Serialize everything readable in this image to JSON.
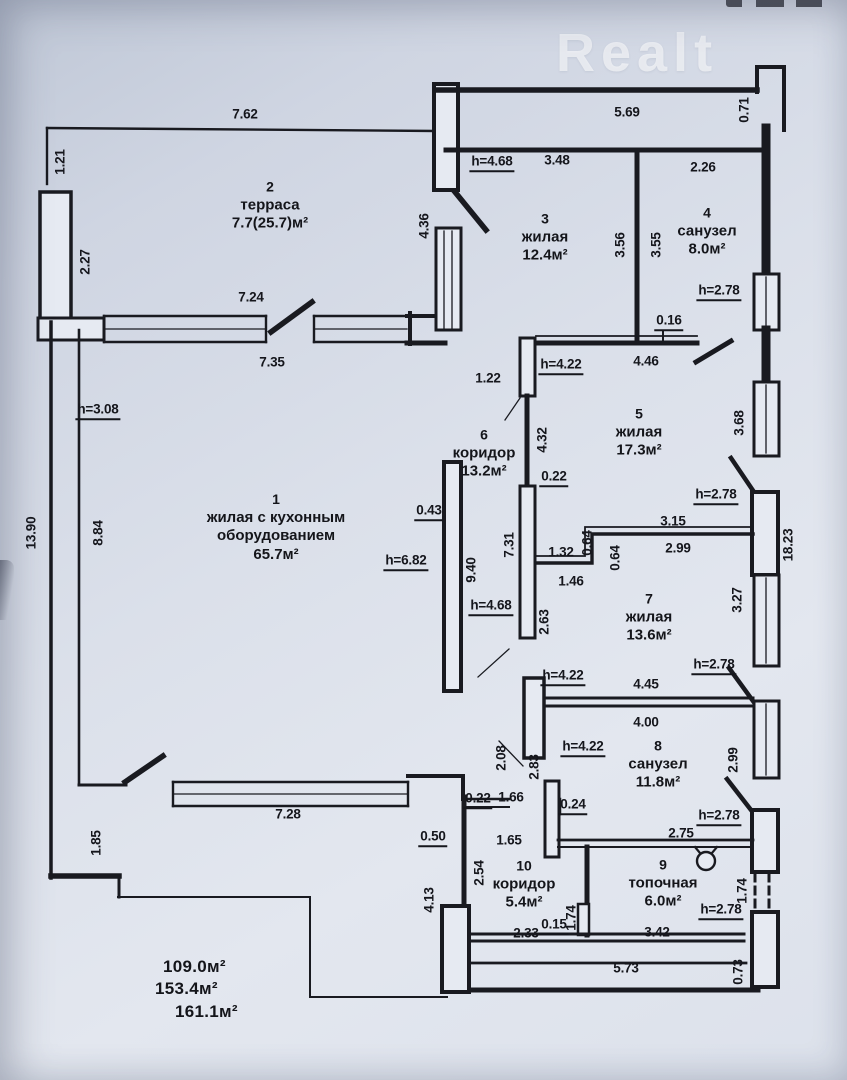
{
  "watermark": "Realt",
  "colors": {
    "paper_top": "#c3cad9",
    "paper_bottom": "#e2e6ee",
    "ink": "#191a20"
  },
  "totals": [
    "109.0м²",
    "153.4м²",
    "161.1м²"
  ],
  "rooms": [
    {
      "lines": [
        "2",
        "терраса",
        "7.7(25.7)м²"
      ],
      "x": 270,
      "y": 206
    },
    {
      "lines": [
        "3",
        "жилая",
        "12.4м²"
      ],
      "x": 545,
      "y": 238
    },
    {
      "lines": [
        "4",
        "санузел",
        "8.0м²"
      ],
      "x": 707,
      "y": 232
    },
    {
      "lines": [
        "5",
        "жилая",
        "17.3м²"
      ],
      "x": 639,
      "y": 433
    },
    {
      "lines": [
        "6",
        "коридор",
        "13.2м²"
      ],
      "x": 484,
      "y": 454
    },
    {
      "lines": [
        "1",
        "жилая с кухонным",
        "оборудованием",
        "65.7м²"
      ],
      "x": 276,
      "y": 528
    },
    {
      "lines": [
        "7",
        "жилая",
        "13.6м²"
      ],
      "x": 649,
      "y": 618
    },
    {
      "lines": [
        "8",
        "санузел",
        "11.8м²"
      ],
      "x": 658,
      "y": 765
    },
    {
      "lines": [
        "10",
        "коридор",
        "5.4м²"
      ],
      "x": 524,
      "y": 885
    },
    {
      "lines": [
        "9",
        "топочная",
        "6.0м²"
      ],
      "x": 663,
      "y": 884
    }
  ],
  "dimensions": [
    {
      "t": "7.62",
      "x": 245,
      "y": 114
    },
    {
      "t": "1.21",
      "x": 60,
      "y": 162,
      "r": 1
    },
    {
      "t": "2.27",
      "x": 85,
      "y": 262,
      "r": 1
    },
    {
      "t": "4.36",
      "x": 424,
      "y": 226,
      "r": 1
    },
    {
      "t": "5.69",
      "x": 627,
      "y": 112
    },
    {
      "t": "0.71",
      "x": 744,
      "y": 110,
      "r": 1
    },
    {
      "t": "h=4.68",
      "x": 492,
      "y": 163,
      "u": 1
    },
    {
      "t": "3.48",
      "x": 557,
      "y": 160
    },
    {
      "t": "2.26",
      "x": 703,
      "y": 167
    },
    {
      "t": "3.56",
      "x": 620,
      "y": 245,
      "r": 1
    },
    {
      "t": "3.55",
      "x": 656,
      "y": 245,
      "r": 1
    },
    {
      "t": "h=2.78",
      "x": 719,
      "y": 292,
      "u": 1
    },
    {
      "t": "7.24",
      "x": 251,
      "y": 297
    },
    {
      "t": "7.35",
      "x": 272,
      "y": 362
    },
    {
      "t": "1.22",
      "x": 488,
      "y": 378
    },
    {
      "t": "h=4.22",
      "x": 561,
      "y": 366,
      "u": 1
    },
    {
      "t": "0.16",
      "x": 669,
      "y": 322,
      "u": 1
    },
    {
      "t": "4.46",
      "x": 646,
      "y": 361
    },
    {
      "t": "h=3.08",
      "x": 98,
      "y": 411,
      "u": 1
    },
    {
      "t": "3.68",
      "x": 739,
      "y": 423,
      "r": 1
    },
    {
      "t": "4.32",
      "x": 542,
      "y": 440,
      "r": 1
    },
    {
      "t": "0.22",
      "x": 554,
      "y": 478,
      "u": 1
    },
    {
      "t": "h=2.78",
      "x": 716,
      "y": 496,
      "u": 1
    },
    {
      "t": "3.15",
      "x": 673,
      "y": 521
    },
    {
      "t": "2.99",
      "x": 678,
      "y": 548
    },
    {
      "t": "0.64",
      "x": 587,
      "y": 543,
      "r": 1
    },
    {
      "t": "0.64",
      "x": 615,
      "y": 558,
      "r": 1
    },
    {
      "t": "1.32",
      "x": 561,
      "y": 552
    },
    {
      "t": "1.46",
      "x": 571,
      "y": 581
    },
    {
      "t": "18.23",
      "x": 788,
      "y": 545,
      "r": 1
    },
    {
      "t": "0.43",
      "x": 429,
      "y": 512,
      "u": 1
    },
    {
      "t": "9.40",
      "x": 471,
      "y": 570,
      "r": 1
    },
    {
      "t": "7.31",
      "x": 509,
      "y": 545,
      "r": 1
    },
    {
      "t": "h=6.82",
      "x": 406,
      "y": 562,
      "u": 1
    },
    {
      "t": "h=4.68",
      "x": 491,
      "y": 607,
      "u": 1
    },
    {
      "t": "2.63",
      "x": 544,
      "y": 622,
      "r": 1
    },
    {
      "t": "3.27",
      "x": 737,
      "y": 600,
      "r": 1
    },
    {
      "t": "13.90",
      "x": 31,
      "y": 533,
      "r": 1
    },
    {
      "t": "8.84",
      "x": 98,
      "y": 533,
      "r": 1
    },
    {
      "t": "h=4.22",
      "x": 563,
      "y": 677,
      "u": 1
    },
    {
      "t": "4.45",
      "x": 646,
      "y": 684
    },
    {
      "t": "h=2.78",
      "x": 714,
      "y": 666,
      "u": 1
    },
    {
      "t": "4.00",
      "x": 646,
      "y": 722
    },
    {
      "t": "h=4.22",
      "x": 583,
      "y": 748,
      "u": 1
    },
    {
      "t": "2.08",
      "x": 501,
      "y": 758,
      "r": 1
    },
    {
      "t": "2.83",
      "x": 534,
      "y": 767,
      "r": 1
    },
    {
      "t": "2.99",
      "x": 733,
      "y": 760,
      "r": 1
    },
    {
      "t": "0.22",
      "x": 478,
      "y": 800,
      "u": 1
    },
    {
      "t": "1.66",
      "x": 511,
      "y": 797
    },
    {
      "t": "0.24",
      "x": 573,
      "y": 806,
      "u": 1
    },
    {
      "t": "1.65",
      "x": 509,
      "y": 840
    },
    {
      "t": "0.50",
      "x": 433,
      "y": 838,
      "u": 1
    },
    {
      "t": "h=2.78",
      "x": 719,
      "y": 817,
      "u": 1
    },
    {
      "t": "2.75",
      "x": 681,
      "y": 833
    },
    {
      "t": "1.85",
      "x": 96,
      "y": 843,
      "r": 1
    },
    {
      "t": "7.28",
      "x": 288,
      "y": 814
    },
    {
      "t": "2.54",
      "x": 479,
      "y": 873,
      "r": 1
    },
    {
      "t": "4.13",
      "x": 429,
      "y": 900,
      "r": 1
    },
    {
      "t": "1.74",
      "x": 571,
      "y": 918,
      "r": 1
    },
    {
      "t": "0.15",
      "x": 554,
      "y": 926,
      "u": 1
    },
    {
      "t": "1.74",
      "x": 742,
      "y": 891,
      "r": 1
    },
    {
      "t": "h=2.78",
      "x": 721,
      "y": 911,
      "u": 1
    },
    {
      "t": "2.33",
      "x": 526,
      "y": 933
    },
    {
      "t": "3.42",
      "x": 657,
      "y": 932
    },
    {
      "t": "5.73",
      "x": 626,
      "y": 968
    },
    {
      "t": "0.73",
      "x": 738,
      "y": 972,
      "r": 1
    }
  ]
}
